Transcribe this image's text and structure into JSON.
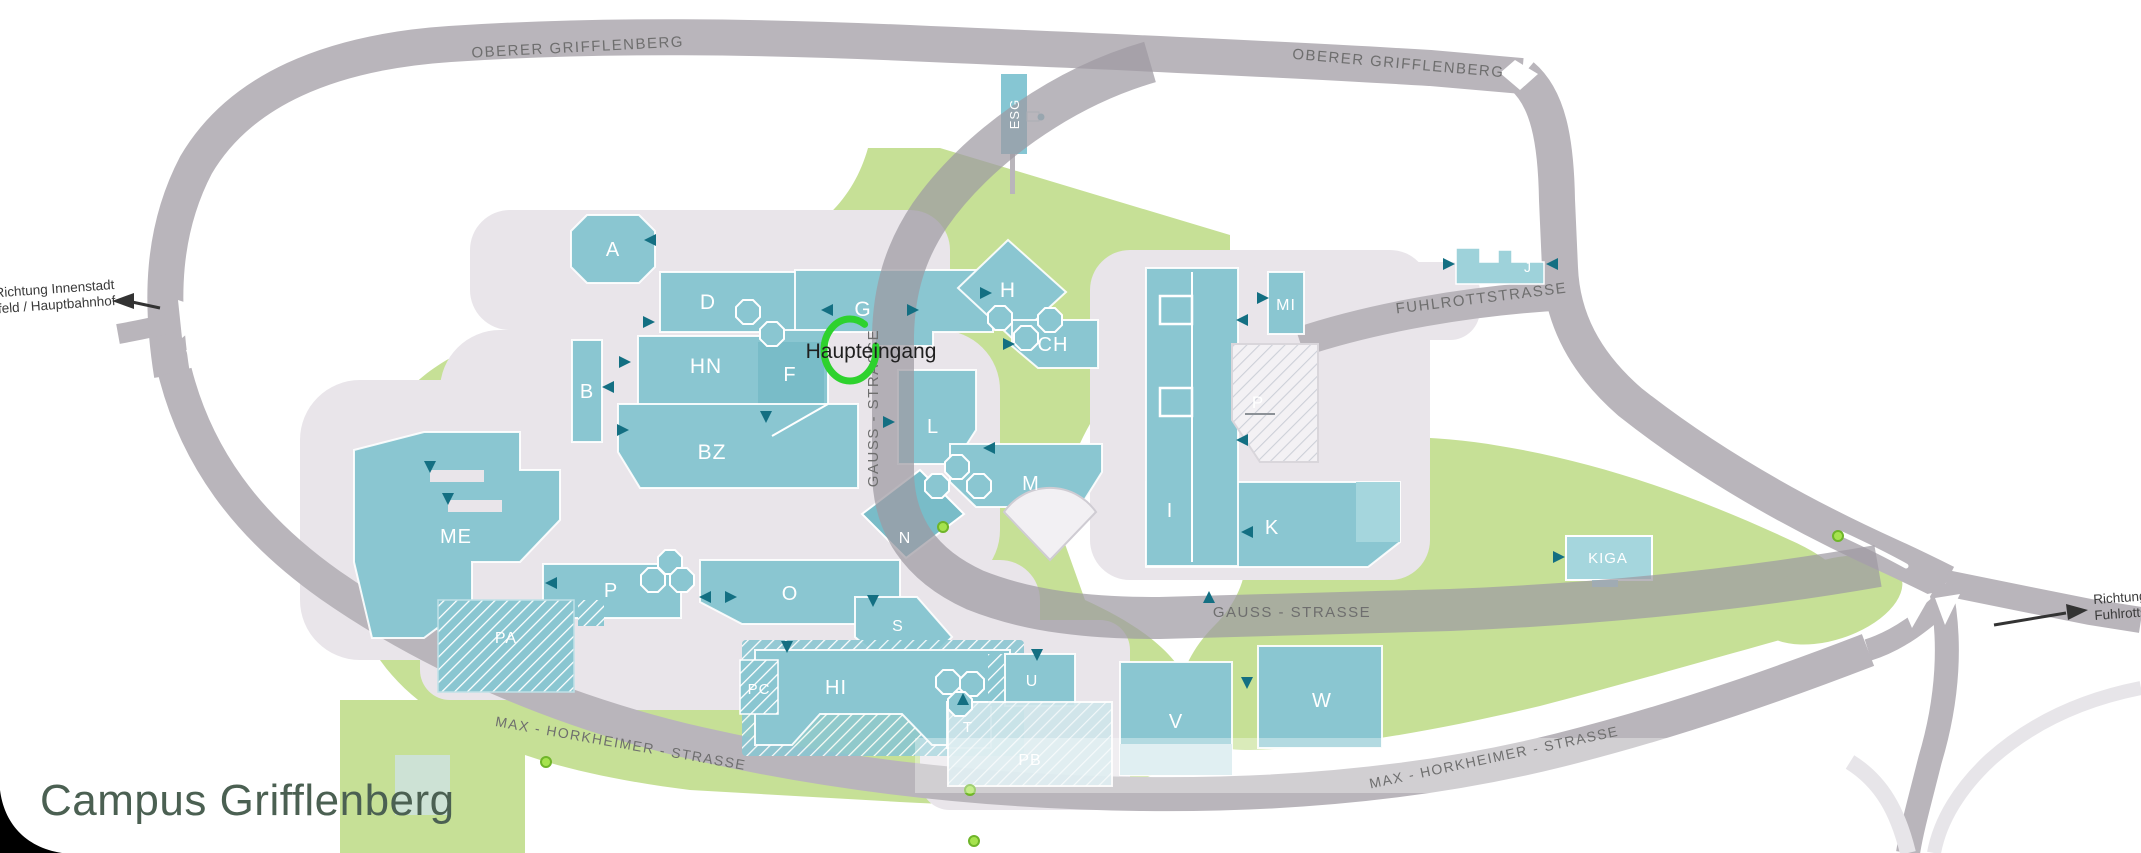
{
  "title": "Campus Grifflenberg",
  "annotation": {
    "main_entrance": "Haupteingang"
  },
  "directions": {
    "west": {
      "line1": "Richtung Innenstadt",
      "line2": "Elberfeld / Hauptbahnhof"
    },
    "east": {
      "line1": "Richtung",
      "line2": "Fuhlrottst"
    }
  },
  "map": {
    "streets": [
      {
        "name": "OBERER GRIFFLENBERG"
      },
      {
        "name": "OBERER GRIFFLENBERG"
      },
      {
        "name": "FUHLROTTSTRASSE"
      },
      {
        "name": "GAUSS - STRASSE"
      },
      {
        "name": "GAUSS - STRASSE"
      },
      {
        "name": "MAX - HORKHEIMER - STRASSE"
      },
      {
        "name": "MAX - HORKHEIMER - STRASSE"
      }
    ],
    "buildings": [
      {
        "code": "A"
      },
      {
        "code": "D"
      },
      {
        "code": "G"
      },
      {
        "code": "H"
      },
      {
        "code": "CH"
      },
      {
        "code": "HN"
      },
      {
        "code": "F"
      },
      {
        "code": "BZ"
      },
      {
        "code": "B"
      },
      {
        "code": "L"
      },
      {
        "code": "M"
      },
      {
        "code": "I"
      },
      {
        "code": "K"
      },
      {
        "code": "MI"
      },
      {
        "code": "P"
      },
      {
        "code": "J"
      },
      {
        "code": "ESG"
      },
      {
        "code": "KIGA"
      },
      {
        "code": "ME"
      },
      {
        "code": "P"
      },
      {
        "code": "PA"
      },
      {
        "code": "O"
      },
      {
        "code": "N"
      },
      {
        "code": "S"
      },
      {
        "code": "PC"
      },
      {
        "code": "HI"
      },
      {
        "code": "T"
      },
      {
        "code": "U"
      },
      {
        "code": "PB"
      },
      {
        "code": "V"
      },
      {
        "code": "W"
      }
    ],
    "entrance_arrows": [
      {
        "x": 651,
        "y": 240,
        "rot": 180
      },
      {
        "x": 648,
        "y": 322,
        "rot": 0
      },
      {
        "x": 828,
        "y": 310,
        "rot": 180
      },
      {
        "x": 912,
        "y": 310,
        "rot": 0
      },
      {
        "x": 985,
        "y": 293,
        "rot": 0
      },
      {
        "x": 1008,
        "y": 344,
        "rot": 0
      },
      {
        "x": 609,
        "y": 387,
        "rot": 180
      },
      {
        "x": 624,
        "y": 362,
        "rot": 0
      },
      {
        "x": 622,
        "y": 430,
        "rot": 0
      },
      {
        "x": 766,
        "y": 416,
        "rot": 90
      },
      {
        "x": 1243,
        "y": 320,
        "rot": 180
      },
      {
        "x": 1243,
        "y": 440,
        "rot": 180
      },
      {
        "x": 1248,
        "y": 532,
        "rot": 180
      },
      {
        "x": 1262,
        "y": 298,
        "rot": 0
      },
      {
        "x": 1448,
        "y": 264,
        "rot": 0
      },
      {
        "x": 1553,
        "y": 264,
        "rot": 180
      },
      {
        "x": 1558,
        "y": 557,
        "rot": 0
      },
      {
        "x": 990,
        "y": 448,
        "rot": 180
      },
      {
        "x": 888,
        "y": 422,
        "rot": 0
      },
      {
        "x": 430,
        "y": 466,
        "rot": 90
      },
      {
        "x": 448,
        "y": 498,
        "rot": 90
      },
      {
        "x": 552,
        "y": 583,
        "rot": 180
      },
      {
        "x": 706,
        "y": 597,
        "rot": 180
      },
      {
        "x": 730,
        "y": 597,
        "rot": 0
      },
      {
        "x": 873,
        "y": 600,
        "rot": 90
      },
      {
        "x": 787,
        "y": 646,
        "rot": 90
      },
      {
        "x": 1037,
        "y": 654,
        "rot": 90
      },
      {
        "x": 1247,
        "y": 682,
        "rot": 90
      },
      {
        "x": 1209,
        "y": 598,
        "rot": 270
      },
      {
        "x": 963,
        "y": 700,
        "rot": 270
      }
    ],
    "bus_stops": [
      {
        "x": 943,
        "y": 527
      },
      {
        "x": 1838,
        "y": 536
      },
      {
        "x": 546,
        "y": 762
      },
      {
        "x": 970,
        "y": 790
      },
      {
        "x": 974,
        "y": 841
      }
    ],
    "octagon_pavilions": [
      {
        "x": 748,
        "y": 312
      },
      {
        "x": 772,
        "y": 334
      },
      {
        "x": 1000,
        "y": 318
      },
      {
        "x": 1026,
        "y": 338
      },
      {
        "x": 1050,
        "y": 320
      },
      {
        "x": 957,
        "y": 467
      },
      {
        "x": 979,
        "y": 486
      },
      {
        "x": 937,
        "y": 486
      },
      {
        "x": 670,
        "y": 562
      },
      {
        "x": 653,
        "y": 580
      },
      {
        "x": 682,
        "y": 580
      },
      {
        "x": 948,
        "y": 682
      },
      {
        "x": 972,
        "y": 684
      },
      {
        "x": 960,
        "y": 704
      }
    ]
  },
  "colors": {
    "building_teal": "#8ac6d1",
    "building_dark": "#79bcc8",
    "building_light": "#a5d6dd",
    "green_space": "#c6e096",
    "road_gray": "#b9b5bb",
    "plaza": "#e9e5ea",
    "entrance_arrow": "#136f82",
    "bus_stop": "#a6e34e",
    "bus_stop_ring": "#6fb52a",
    "annotation_green": "#2ed22e",
    "title_color": "#4b6052",
    "street_label": "#6e6e6e"
  }
}
